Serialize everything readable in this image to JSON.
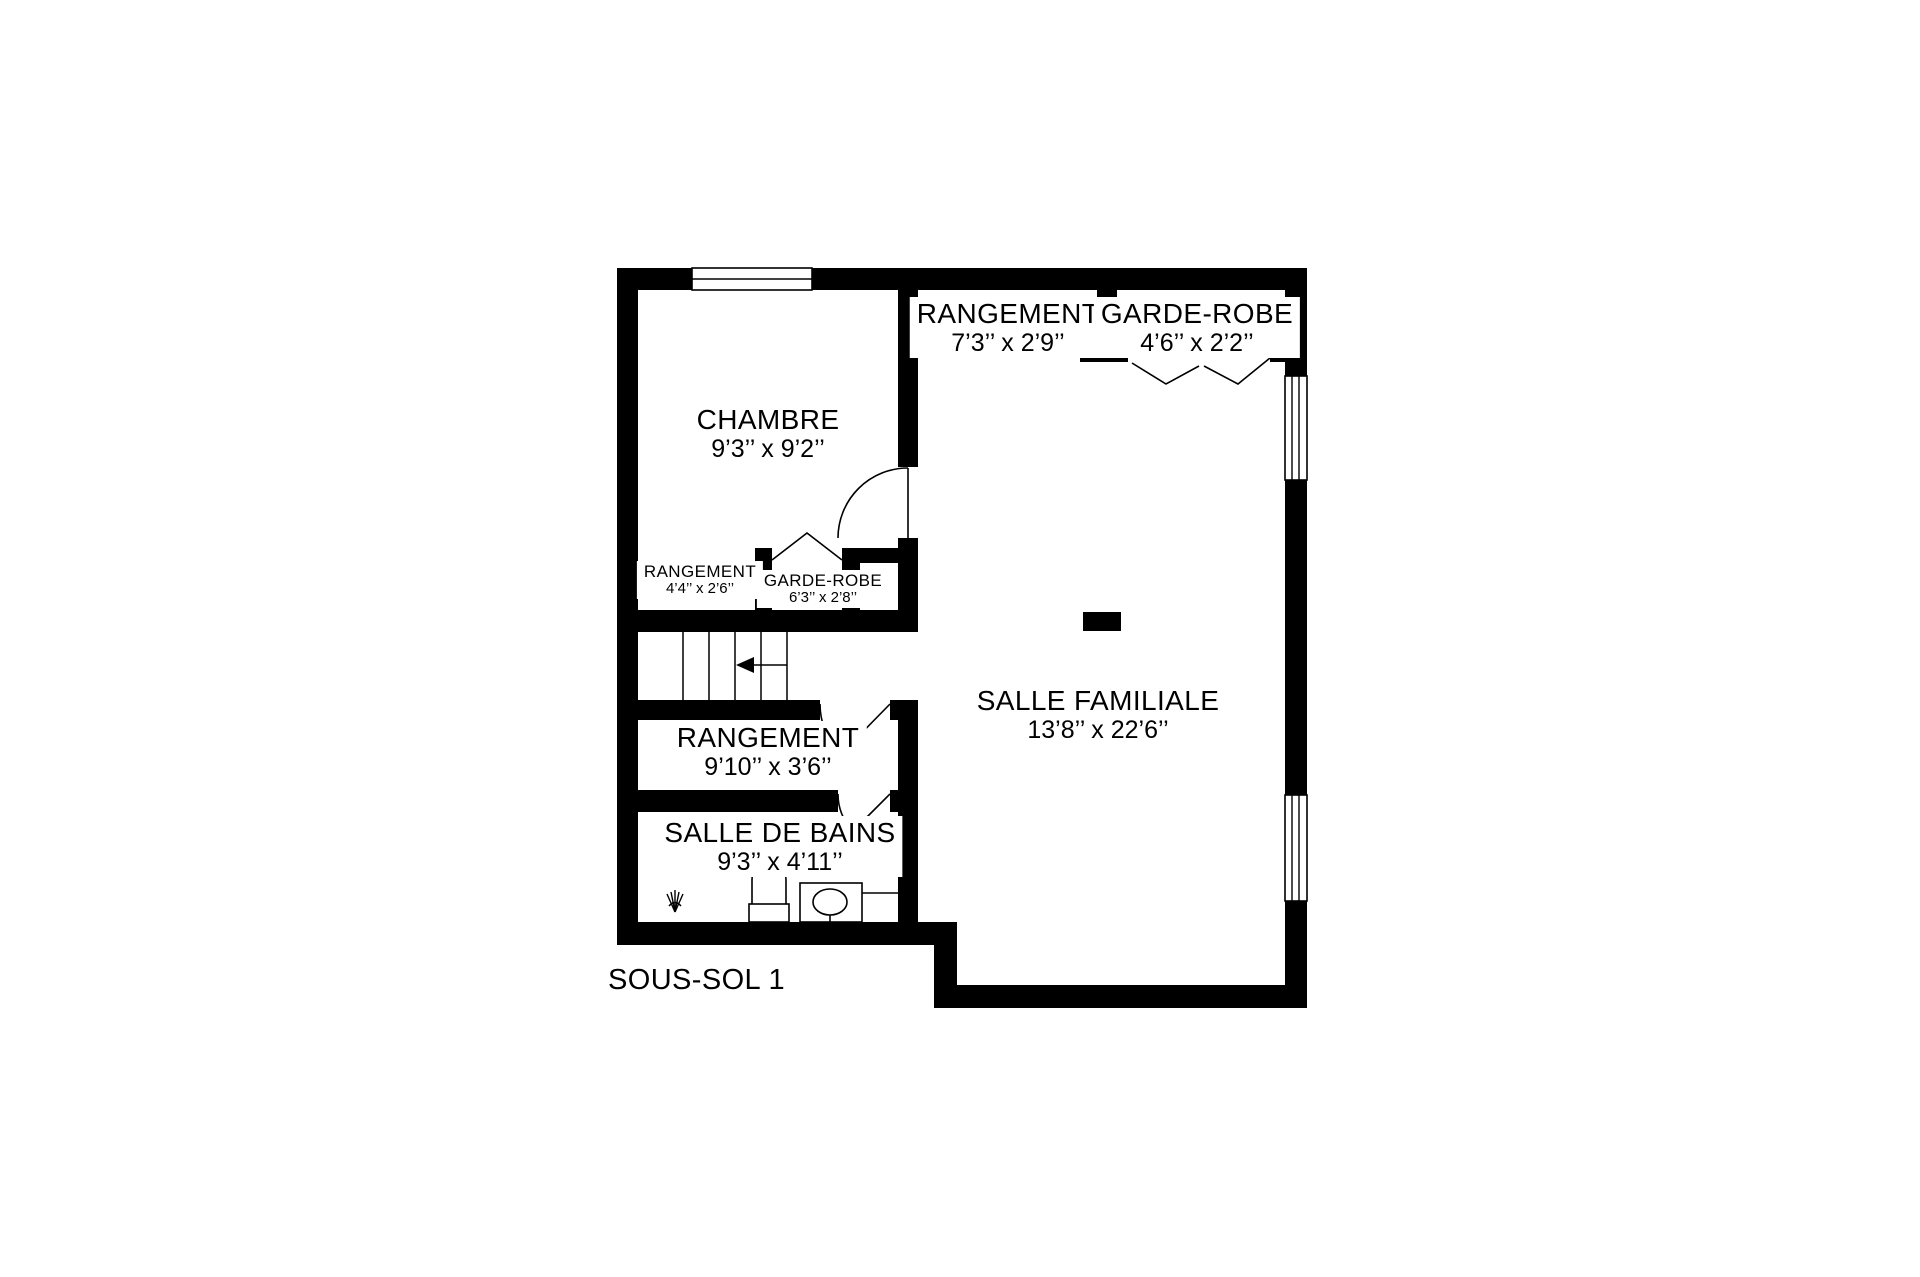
{
  "plan": {
    "floor_label": "SOUS-SOL 1",
    "rooms": [
      {
        "id": "chambre",
        "name": "CHAMBRE",
        "dimensions": "9’3’’ x 9’2’’"
      },
      {
        "id": "rangement-haut",
        "name": "RANGEMENT",
        "dimensions": "7’3’’ x 2’9’’"
      },
      {
        "id": "garde-robe-haut",
        "name": "GARDE-ROBE",
        "dimensions": "4’6’’ x 2’2’’"
      },
      {
        "id": "rangement-chambre",
        "name": "RANGEMENT",
        "dimensions": "4’4’’ x 2’6’’"
      },
      {
        "id": "garde-robe-chambre",
        "name": "GARDE-ROBE",
        "dimensions": "6’3’’ x 2’8’’"
      },
      {
        "id": "salle-familiale",
        "name": "SALLE FAMILIALE",
        "dimensions": "13’8’’ x 22’6’’"
      },
      {
        "id": "rangement-bas",
        "name": "RANGEMENT",
        "dimensions": "9’10’’ x 3’6’’"
      },
      {
        "id": "salle-de-bains",
        "name": "SALLE DE BAINS",
        "dimensions": "9’3’’ x 4’11’’"
      }
    ],
    "features": [
      "window",
      "door-swing",
      "bifold-door",
      "stairs",
      "stairs-direction-arrow",
      "toilet",
      "sink-vanity",
      "shower-head",
      "support-post"
    ],
    "colors": {
      "walls": "#000000",
      "background": "#ffffff",
      "lines": "#000000"
    }
  }
}
